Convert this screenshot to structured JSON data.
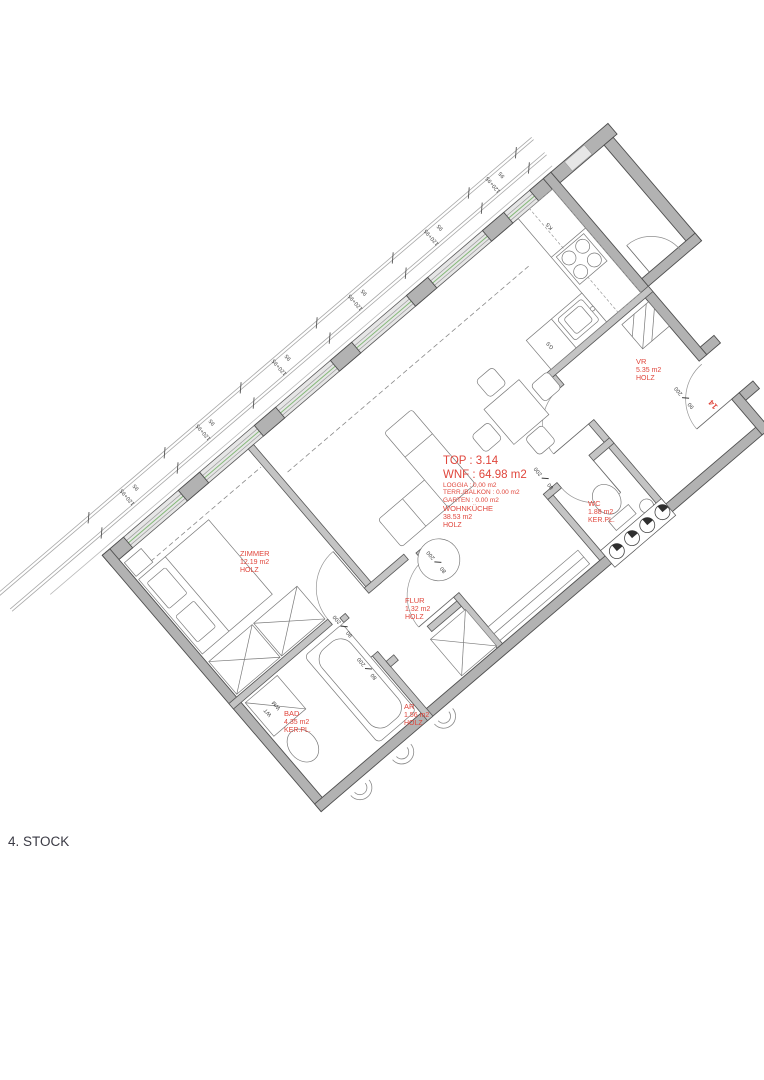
{
  "floor_label": "4. STOCK",
  "colors": {
    "accent_red": "#e0463c",
    "wall_gray": "#b2b2b2",
    "line_gray": "#5a5a5a",
    "glazing_green": "#84b878"
  },
  "title_block": {
    "top": "TOP : 3.14",
    "wnf": "WNF : 64.98 m2",
    "loggia": "LOGGIA : 0,00 m2",
    "terr_balkon": "TERR./BALKON : 0.00 m2",
    "garten": "GARTEN : 0.00 m2"
  },
  "rooms": [
    {
      "name": "WOHNKÜCHE",
      "area": "38.53 m2",
      "floor": "HOLZ"
    },
    {
      "name": "ZIMMER",
      "area": "12.19 m2",
      "floor": "HOLZ"
    },
    {
      "name": "FLUR",
      "area": "1.32 m2",
      "floor": "HOLZ"
    },
    {
      "name": "BAD",
      "area": "4.35 m2",
      "floor": "KER.PL."
    },
    {
      "name": "AR",
      "area": "1.56 m2",
      "floor": "HOLZ"
    },
    {
      "name": "WC",
      "area": "1.88 m2",
      "floor": "KER.PL."
    },
    {
      "name": "VR",
      "area": "5.35 m2",
      "floor": "HOLZ"
    }
  ],
  "door_dims": [
    {
      "w": "80",
      "h": "200"
    },
    {
      "w": "80",
      "h": "200"
    },
    {
      "w": "80",
      "h": "200"
    },
    {
      "w": "80",
      "h": "200"
    },
    {
      "w": "90",
      "h": "200"
    }
  ],
  "window_dims": {
    "outer": "95",
    "inner": "120+95"
  },
  "appliances": {
    "fridge_label": "KS",
    "dishwasher_label": "GS",
    "washbasin_label": "WT",
    "washing_machine_label": "WM"
  },
  "unit_number": "14"
}
